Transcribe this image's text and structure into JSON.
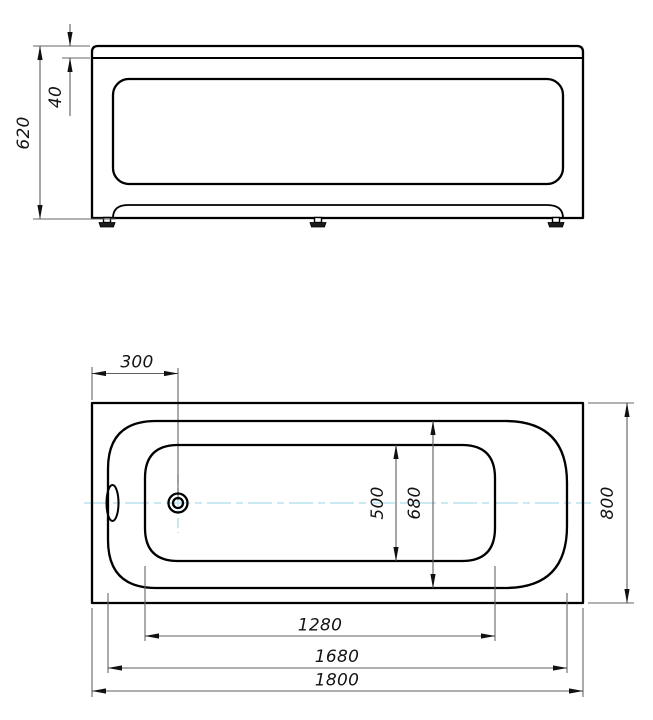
{
  "drawing": {
    "background": "#ffffff",
    "colors": {
      "object_line": "#000000",
      "dimension_line": "#5d5d5d",
      "arrow": "#111111",
      "text": "#141414",
      "centerline": "#b8e2ee"
    },
    "front_view": {
      "dims": {
        "overall_height": {
          "label": "620"
        },
        "rim_height": {
          "label": "40"
        }
      }
    },
    "plan_view": {
      "dims": {
        "drain_offset": {
          "label": "300"
        },
        "bottom_width": {
          "label": "500"
        },
        "rim_opening_width": {
          "label": "680"
        },
        "overall_width": {
          "label": "800"
        },
        "bottom_length": {
          "label": "1280"
        },
        "rim_opening_length": {
          "label": "1680"
        },
        "overall_length": {
          "label": "1800"
        }
      }
    }
  }
}
